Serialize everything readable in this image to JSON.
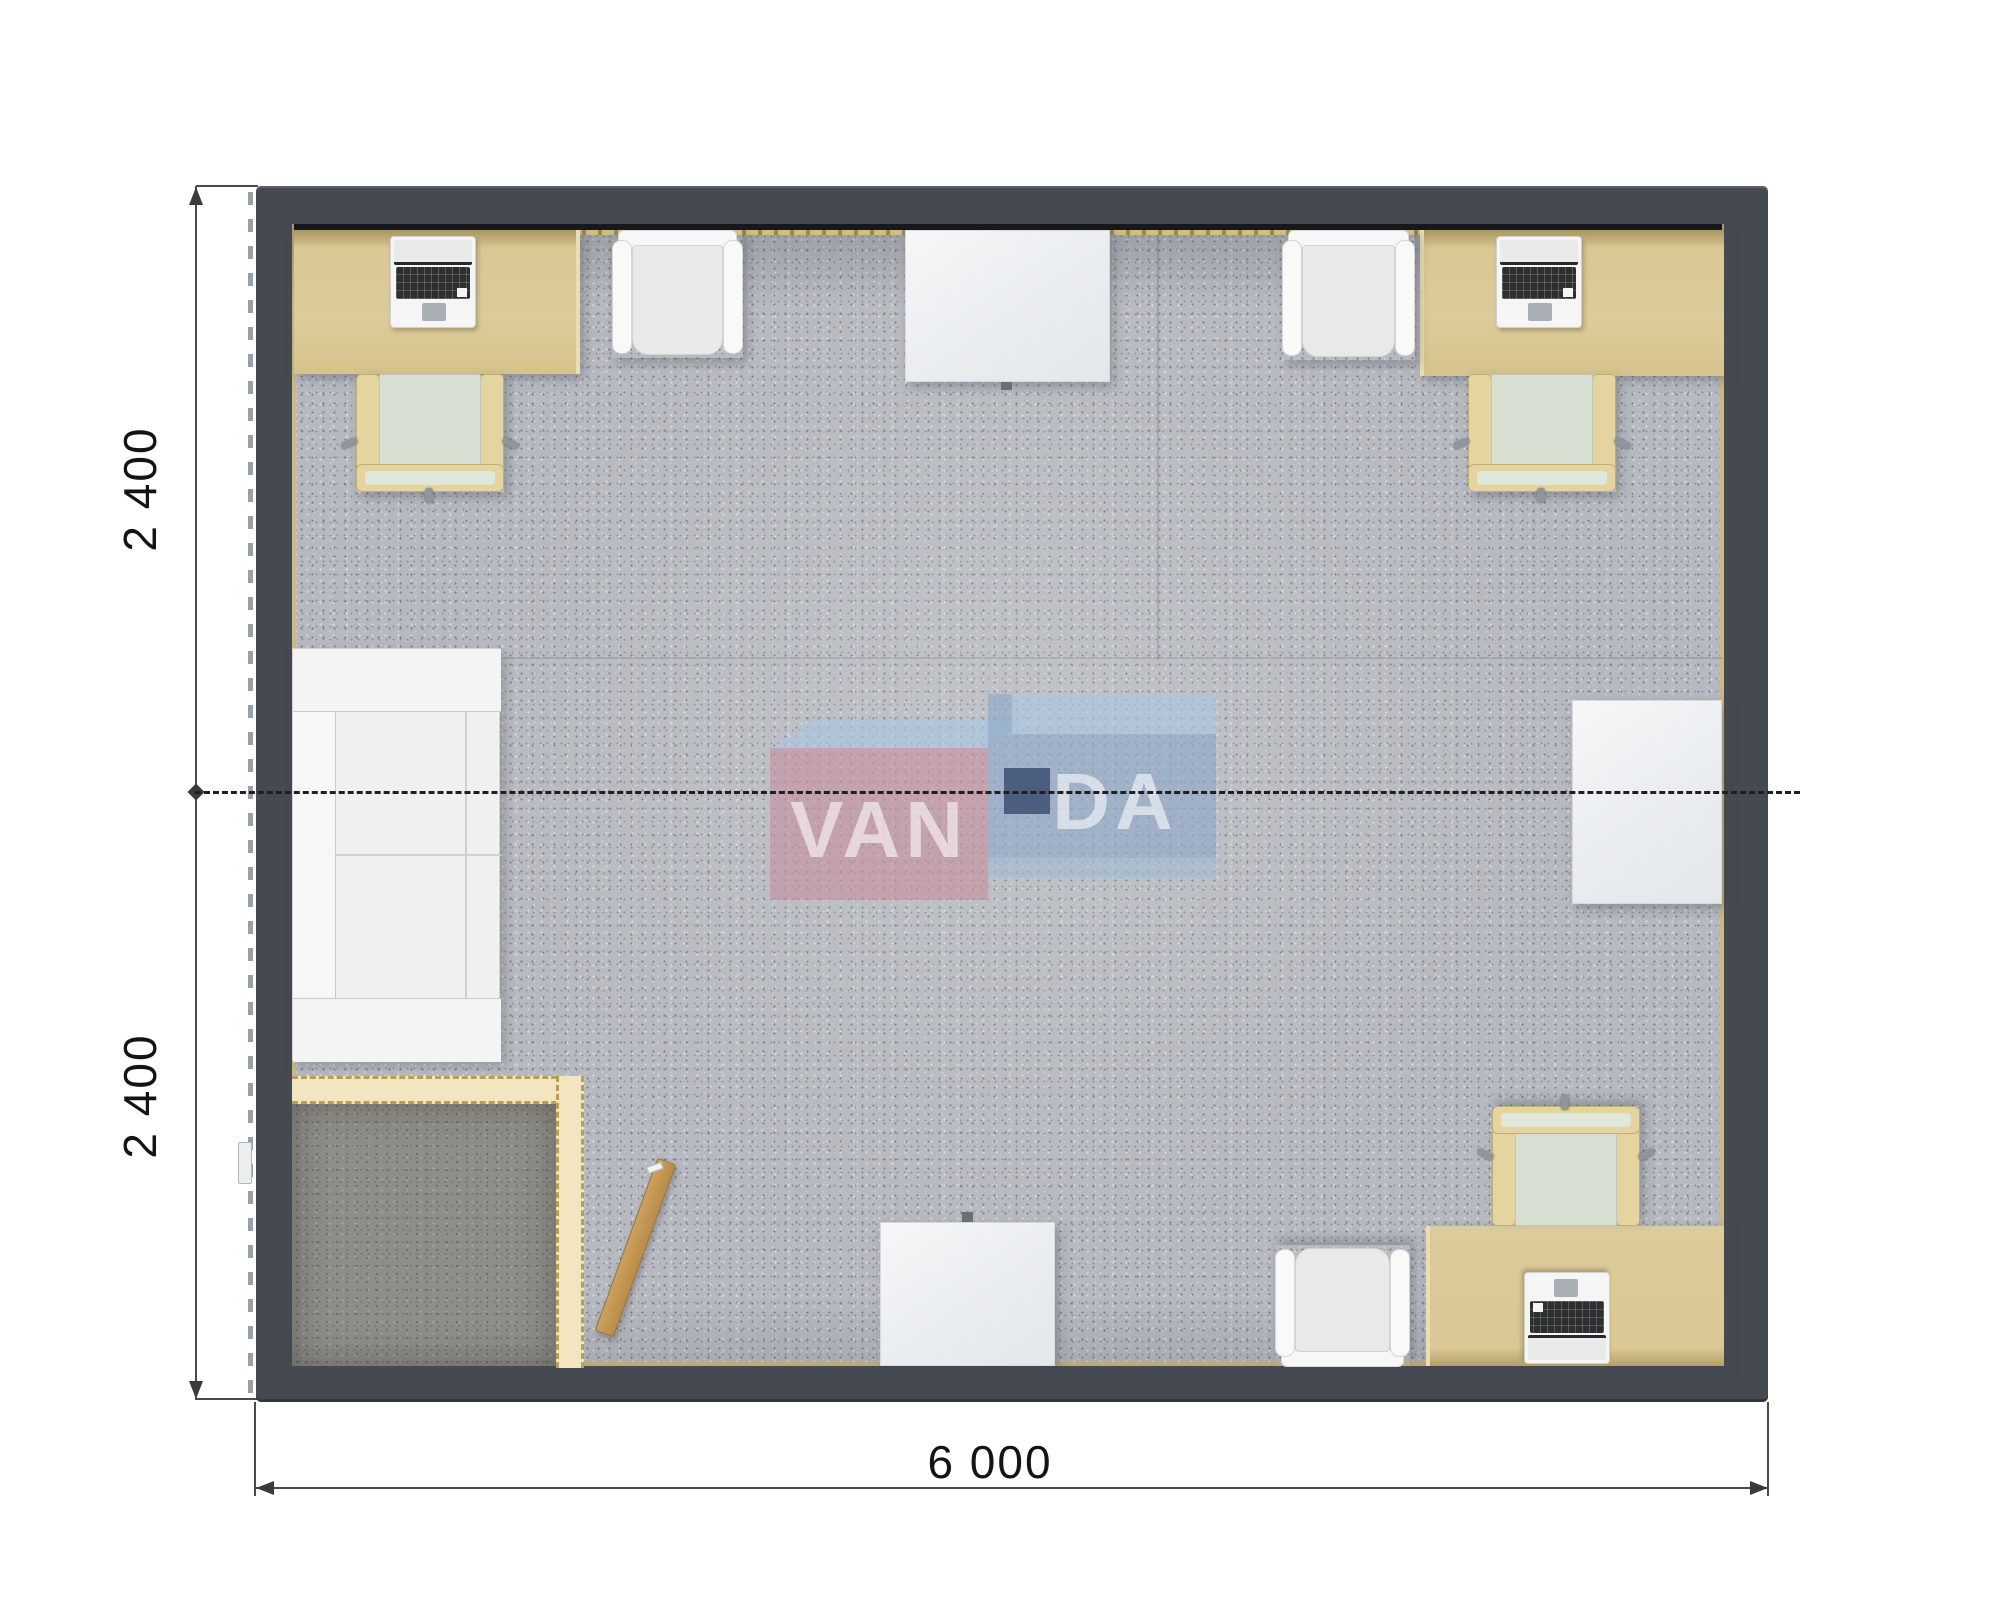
{
  "plan": {
    "type": "top-down 3D floor plan render of a modular container office",
    "dimensions": {
      "left_top": "2 400",
      "left_bottom": "2 400",
      "bottom": "6 000"
    },
    "watermark": {
      "brand": "VANDA",
      "left_text": "VAN",
      "right_text": "DA",
      "pink": "#c78fa0",
      "blue": "#8fa9c9",
      "light_blue": "#abc8e2",
      "navy_square": "#45577a"
    },
    "palette": {
      "wall": "#454a52",
      "carpet": "#b6b9bf",
      "desk_wood": "#d9c795",
      "chair_frame": "#e4d4a0",
      "chair_seat_mint": "#d8e0d3",
      "white_furniture": "#f0f2f1",
      "vestibule_wall": "#f2e6c0",
      "vestibule_floor": "#8e8d87",
      "door_leaf": "#c49a58",
      "baseboard": "#cdb87f"
    },
    "furniture": [
      "desk-with-laptop-top-left",
      "office-chair-top-left",
      "armchair-top-left",
      "table-top-center",
      "armchair-top-right",
      "desk-with-laptop-top-right",
      "office-chair-top-right",
      "sofa-left-wall",
      "vestibule-with-open-door-bottom-left",
      "table-bottom-center",
      "armchair-bottom-right",
      "desk-with-laptop-bottom-right",
      "office-chair-bottom-right",
      "side-table-right-wall"
    ]
  }
}
